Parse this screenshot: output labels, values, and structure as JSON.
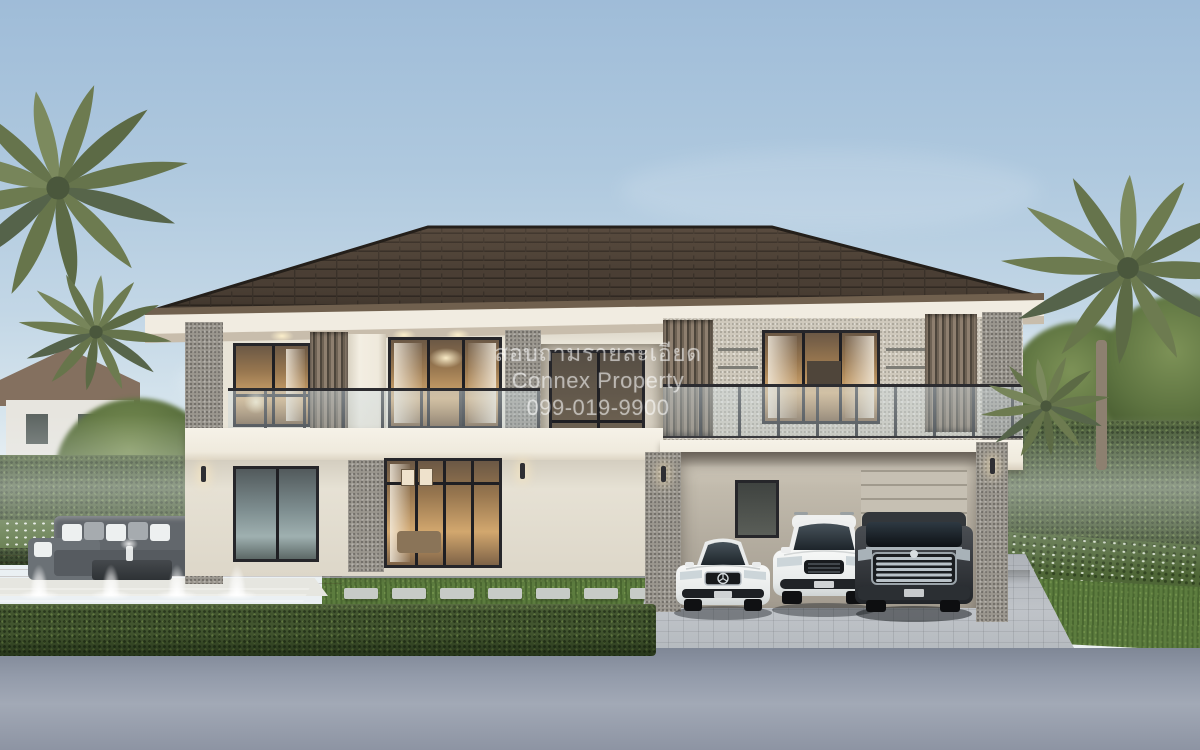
{
  "image": {
    "kind": "3d-architectural-rendering",
    "subject": "Modern two-storey luxury house with dark hip roof, stone-clad pillars, wood louvers, glass balconies, pool garden with fountains, outdoor sofa set and three cars parked at the carport",
    "setting": "daylight, pale blue sky, palm trees left and right, trimmed hedges, grey asphalt road in the foreground"
  },
  "watermark": {
    "line1": "สอบถามรายละเอียด",
    "line2": "Connex Property",
    "line3": "099-019-9900"
  },
  "objects": {
    "storeys": 2,
    "fountain_jet_count": 4,
    "cars": [
      "white luxury sedan",
      "white SUV",
      "dark grey luxury van"
    ]
  },
  "palette": {
    "sky_top": "#9fbcd8",
    "sky_horizon": "#e9eff2",
    "roof_shingle": "#453a30",
    "fascia_white": "#f1ece1",
    "wall_cream": "#e9e4d7",
    "stone_grey": "#9a968e",
    "louver_wood": "#8e7f6f",
    "window_frame": "#26262a",
    "interior_glow": "#d2a76e",
    "hedge_green": "#42552f",
    "lawn_green": "#5c7c3e",
    "pool_water": "#9fc6cc",
    "pool_deck": "#b48a7a",
    "driveway_pavers": "#b9bdc2",
    "road_asphalt": "#98a0ae"
  }
}
